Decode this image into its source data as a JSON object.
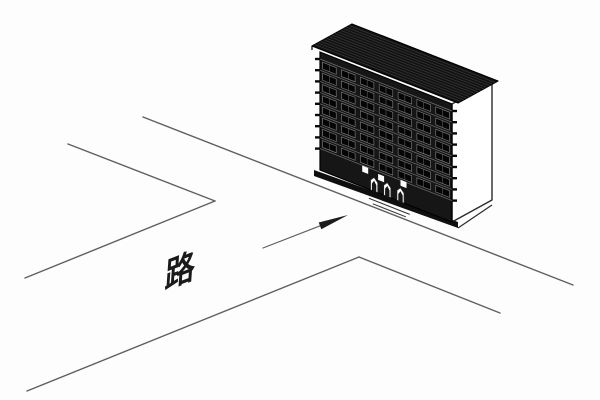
{
  "canvas": {
    "width": 600,
    "height": 400,
    "background": "#fdfdfd"
  },
  "palette": {
    "road_line": "#5f5f5f",
    "building_ink": "#000000",
    "facade_fill": "#161616",
    "roof_fill": "#121212",
    "roof_hatch": "#3a3a3a",
    "window_fill": "#050505",
    "window_stroke": "#8f8f8f",
    "grid_line": "#6f6f6f",
    "tick_ink": "#0a0a0a",
    "side_fill": "#ffffff",
    "side_stroke": "#2b2b2b",
    "accent_white": "#ffffff",
    "door_stroke": "#222222",
    "step_ink": "#333333",
    "arrow_ink": "#1c1c1c",
    "plinth_fill": "#0f0f0f"
  },
  "labels": {
    "road": "路"
  },
  "diagram": {
    "road_edges": [
      {
        "name": "frontage-edge",
        "x1": 143,
        "y1": 117,
        "x2": 573,
        "y2": 285
      },
      {
        "name": "near-edge-northwest",
        "x1": 68,
        "y1": 144,
        "x2": 215,
        "y2": 201
      },
      {
        "name": "branch-west-edge",
        "x1": 215,
        "y1": 201,
        "x2": 25,
        "y2": 278
      },
      {
        "name": "near-edge-southeast",
        "x1": 359,
        "y1": 257,
        "x2": 500,
        "y2": 313
      },
      {
        "name": "branch-east-edge",
        "x1": 359,
        "y1": 257,
        "x2": 27,
        "y2": 391
      }
    ],
    "entrance_arrow": {
      "tail": [
        263,
        248
      ],
      "tip": [
        348,
        215
      ],
      "head_length": 30,
      "head_half_width": 3.6,
      "shaft_width": 1.2
    },
    "road_label": {
      "x": 180,
      "y": 271,
      "rotate": -21,
      "skew_x": -25,
      "font_size": 32
    },
    "building": {
      "facade_top_left": [
        320,
        52
      ],
      "width_vector": [
        132,
        52
      ],
      "height": 118,
      "depth_vector": [
        40,
        -22
      ],
      "roof_front_left": [
        312,
        46
      ],
      "roof_width_vector": [
        146,
        57
      ],
      "roof_hatch_count": 13,
      "floors": 8,
      "window_columns": 7,
      "window_row_start": 7,
      "window_row_height": 11.2,
      "ground_windows": [
        {
          "u": 0.32,
          "v": 97
        },
        {
          "u": 0.44,
          "v": 99
        },
        {
          "u": 0.61,
          "v": 96
        }
      ],
      "ground_window_size": 6,
      "doors": [
        {
          "u": 0.41
        },
        {
          "u": 0.51
        },
        {
          "u": 0.61
        }
      ],
      "door_width_u": 0.055,
      "door_top_v": 104,
      "plinth_extend": 6,
      "plinth_depth": 6,
      "steps": [
        {
          "u1": 0.37,
          "u2": 0.68,
          "dy": 3
        },
        {
          "u1": 0.4,
          "u2": 0.65,
          "dy": 7
        }
      ]
    }
  }
}
